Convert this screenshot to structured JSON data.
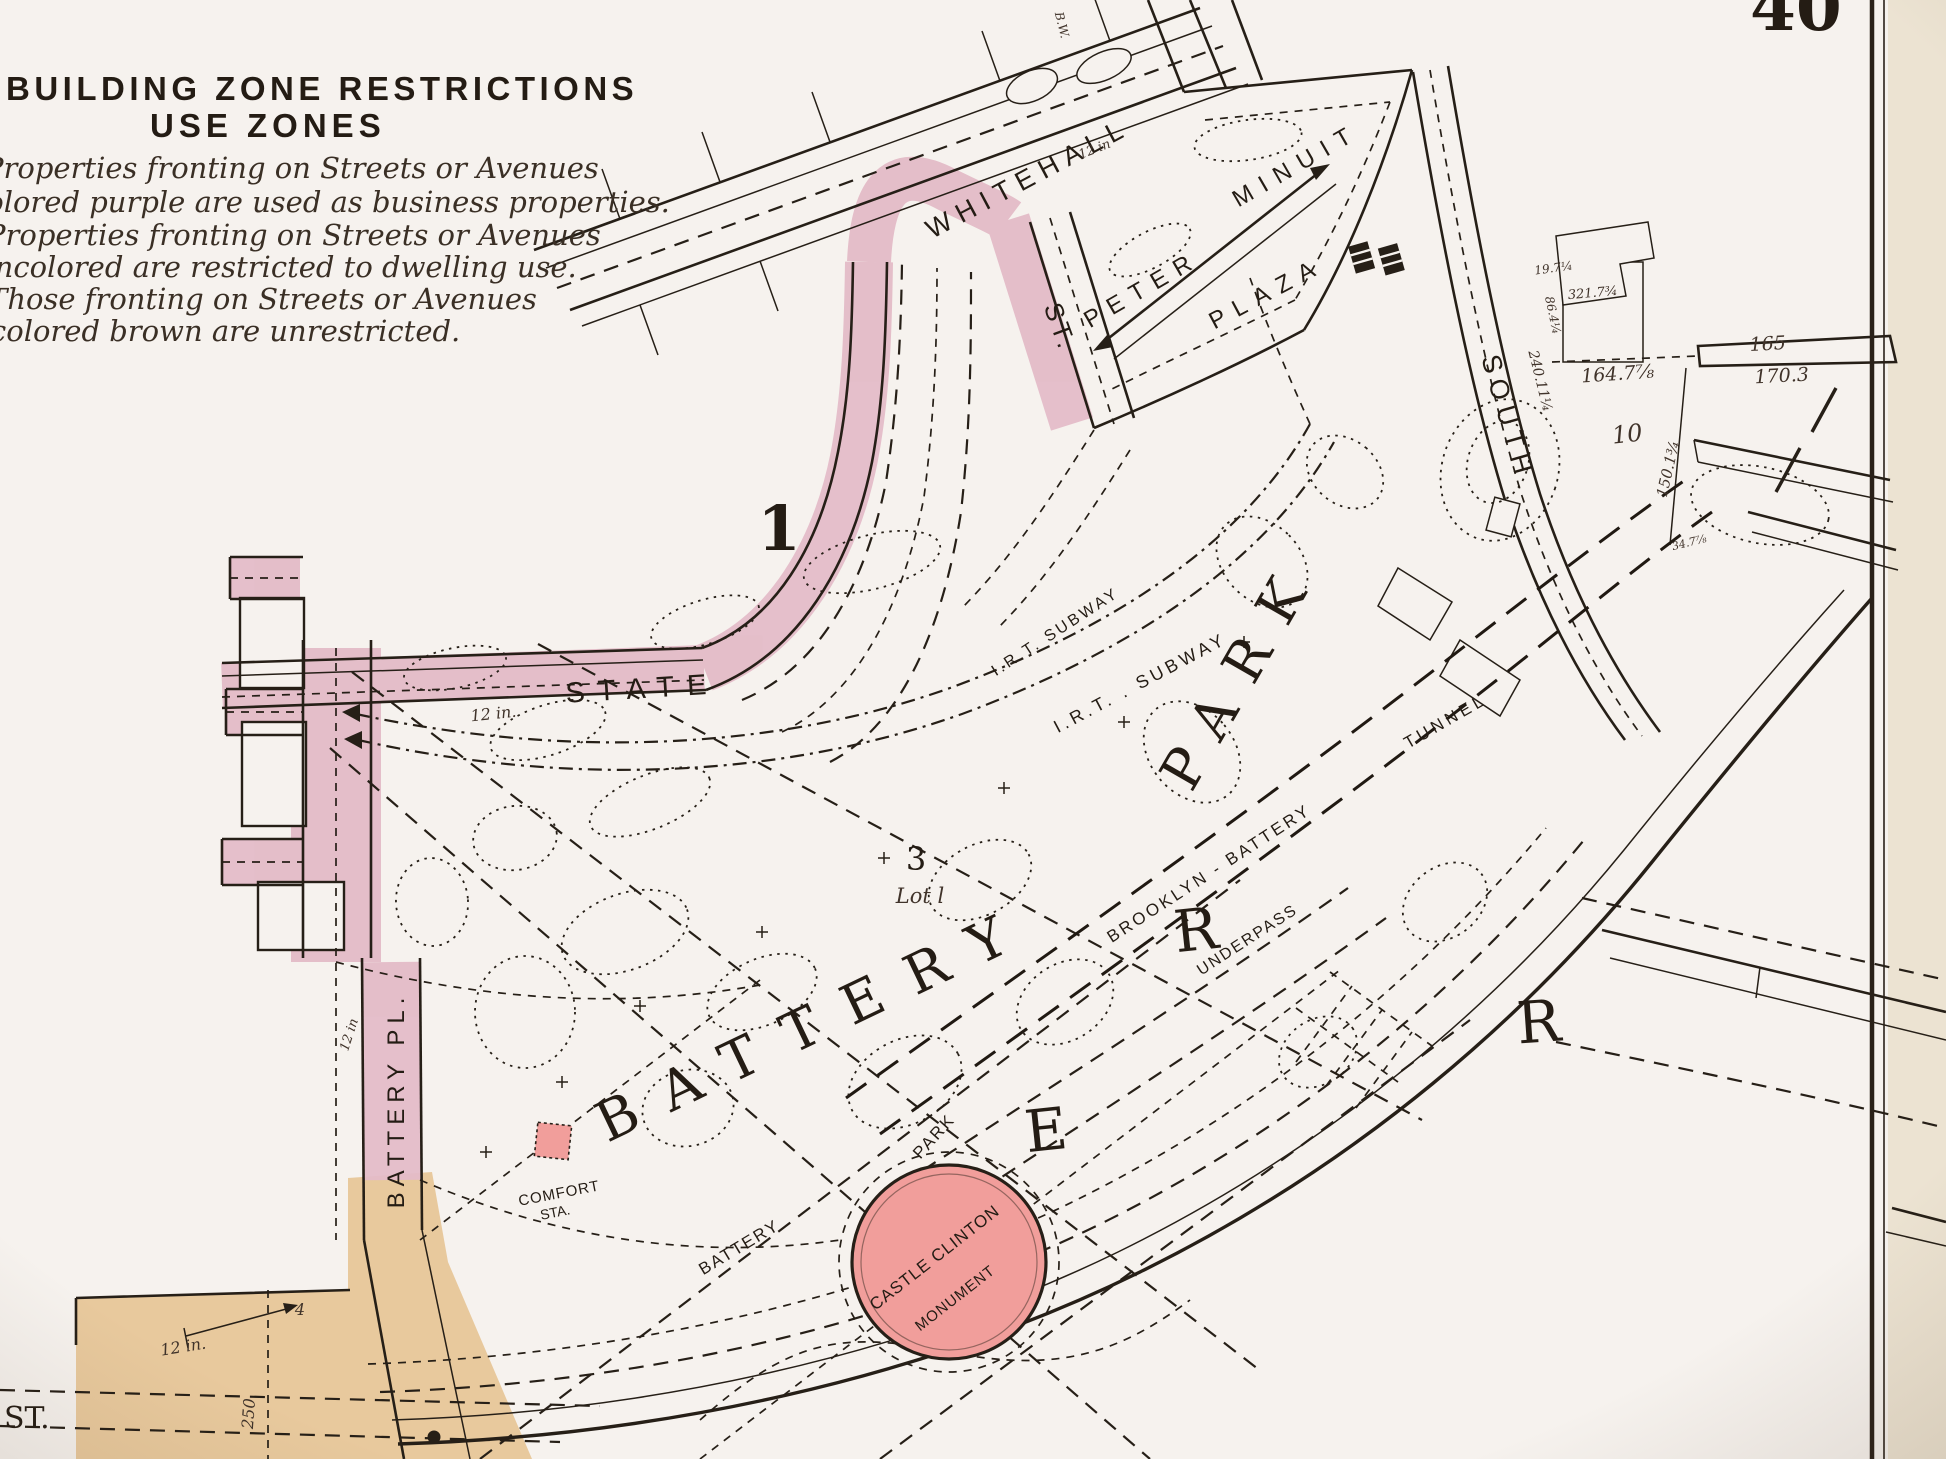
{
  "page": {
    "plate_number": "40",
    "colors": {
      "paper": "#f6f2ee",
      "page_margin": "#ece3d2",
      "ink": "#261f17",
      "street_pink": "#e4bcc8",
      "monument_pink": "#f19e9b",
      "unrestricted_tan": "#e6c392"
    }
  },
  "legend": {
    "title_line1": "BUILDING ZONE RESTRICTIONS",
    "title_line2": "USE ZONES",
    "lines": [
      "Properties fronting on Streets or Avenues",
      "colored purple are used as business properties.",
      "Properties fronting on Streets or Avenues",
      "uncolored are restricted to dwelling use.",
      "Those fronting on Streets or Avenues",
      "colored brown are unrestricted."
    ]
  },
  "map": {
    "labels": {
      "block_1": "1",
      "block_3": "3",
      "lot_1": "Lot l",
      "block_10": "10",
      "state": "STATE",
      "whitehall": "WHITEHALL",
      "whitehall_st": "ST.",
      "battery_pl": "BATTERY  PL.",
      "south": "SOUTH",
      "peter": "PETER",
      "minuit": "MINUIT",
      "plaza": "PLAZA",
      "irt_subway_1": "I.R.T.  SUBWAY",
      "irt_subway_2": "I.R.T. . SUBWAY",
      "brooklyn_battery": "BROOKLYN - BATTERY",
      "tunnel": "TUNNEL",
      "underpass": "UNDERPASS",
      "battery_big": "BATTERY",
      "park_big": "PARK",
      "battery_walk": "BATTERY",
      "park_walk": "PARK",
      "castle_clinton": "CASTLE CLINTON",
      "monument": "MONUMENT",
      "comfort": "COMFORT",
      "comfort_sta": "STA.",
      "river_e": "E",
      "river_r1": "R",
      "river_r2": "R",
      "st_bottom": "ST.",
      "dim_250": "250",
      "num_4": "4",
      "dim_12in_state": "12 in.",
      "dim_12in_whitehall": "12 in",
      "dim_12in_battery_pl": "12 in",
      "dim_12in_bottom": "12 in.",
      "bw": "B.W.",
      "d_165": "165",
      "d_170_3": "170.3",
      "d_164_7": "164.7⅞",
      "d_150_1": "150.1¾",
      "d_240_11": "240.11¼",
      "d_86_4": "86.4¼",
      "d_321_7": "321.7¾",
      "d_19_7": "19.7¼",
      "d_34_7": "34.7⅞"
    }
  }
}
